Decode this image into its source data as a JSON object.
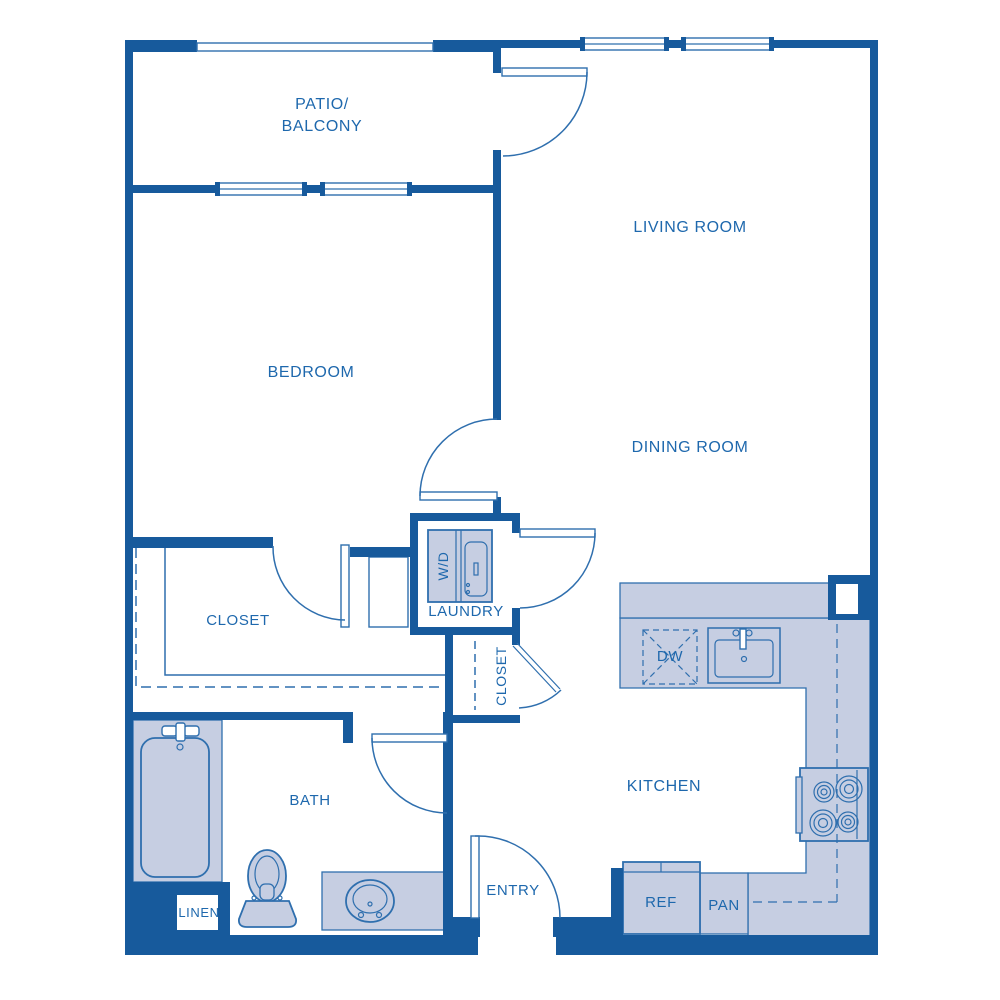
{
  "document_type": "apartment-floor-plan",
  "colors": {
    "wall": "#175a9c",
    "fixture_fill": "#c6cee2",
    "line": "#2f6fae",
    "text": "#1e68ad",
    "background": "#ffffff"
  },
  "labels": {
    "patio_line1": "PATIO/",
    "patio_line2": "BALCONY",
    "living": "LIVING ROOM",
    "bedroom": "BEDROOM",
    "dining": "DINING ROOM",
    "closet_bedroom": "CLOSET",
    "laundry": "LAUNDRY",
    "wd": "W/D",
    "closet_entry": "CLOSET",
    "dw": "DW",
    "kitchen": "KITCHEN",
    "bath": "BATH",
    "linen": "LINEN",
    "entry": "ENTRY",
    "ref": "REF",
    "pan": "PAN"
  },
  "fixtures": [
    "bathtub",
    "tub-faucet",
    "toilet",
    "bathroom-sink",
    "vanity-counter",
    "washer-dryer-unit",
    "dishwasher",
    "kitchen-sink",
    "range-stove",
    "refrigerator",
    "pantry-cabinet",
    "breakfast-bar",
    "kitchen-counter",
    "closet-shelf-outline",
    "closet-rod-dashed",
    "upper-cabinet-dashed"
  ],
  "windows_count": 4,
  "doors_count": 7
}
